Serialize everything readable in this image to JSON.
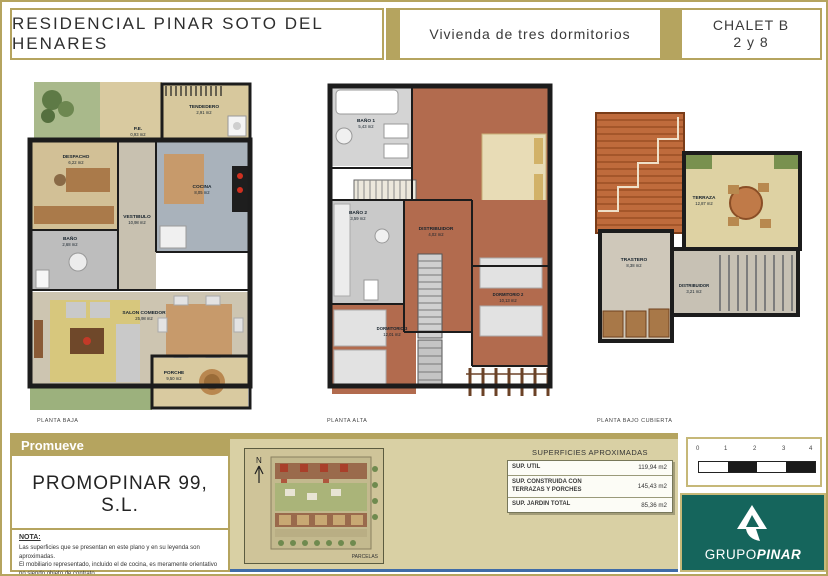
{
  "header": {
    "project_title": "RESIDENCIAL PINAR SOTO DEL HENARES",
    "dwelling_type": "Vivienda de tres dormitorios",
    "chalet_line1": "CHALET B",
    "chalet_line2": "2 y 8"
  },
  "plans": [
    {
      "name": "PLANTA BAJA",
      "rooms": [
        {
          "label": "TENDEDERO",
          "area": "2,91 m2"
        },
        {
          "label": "P.E.",
          "area": "0,93 m2"
        },
        {
          "label": "DESPACHO",
          "area": "6,22 m2"
        },
        {
          "label": "COCINA",
          "area": "8,05 m2"
        },
        {
          "label": "VESTIBULO",
          "area": "10,98 m2"
        },
        {
          "label": "BAÑO",
          "area": "2,68 m2"
        },
        {
          "label": "SALON COMEDOR",
          "area": "25,98 m2"
        },
        {
          "label": "PORCHE",
          "area": "9,50 m2"
        }
      ]
    },
    {
      "name": "PLANTA ALTA",
      "rooms": [
        {
          "label": "BAÑO 1",
          "area": "5,43 m2"
        },
        {
          "label": "DORMITORIO PRINCIPAL",
          "area": "11,75 m2"
        },
        {
          "label": "BAÑO 2",
          "area": "3,59 m2"
        },
        {
          "label": "DISTRIBUIDOR",
          "area": "4,02 m2"
        },
        {
          "label": "DORMITORIO 3",
          "area": "12,01 m2"
        },
        {
          "label": "DORMITORIO 2",
          "area": "10,13 m2"
        }
      ]
    },
    {
      "name": "PLANTA BAJO CUBIERTA",
      "rooms": [
        {
          "label": "TERRAZA",
          "area": "12,87 m2"
        },
        {
          "label": "TRASTERO",
          "area": "8,38 m2"
        },
        {
          "label": "DISTRIBUIDOR",
          "area": "3,21 m2"
        }
      ]
    }
  ],
  "promoter": {
    "band_label": "Promueve",
    "company": "PROMOPINAR 99, S.L."
  },
  "note": {
    "title": "NOTA:",
    "lines": [
      "Las superficies que se presentan en este plano y en su leyenda son aproximadas.",
      "El mobiliario representado, incluido el de cocina, es meramente orientativo no siendo objeto de contrato.",
      "Este plano queda sujeto a posibles modificaciones de carácter técnico."
    ]
  },
  "site_plan": {
    "north_label": "N",
    "caption": "PARCELAS"
  },
  "surfaces": {
    "title": "SUPERFICIES APROXIMADAS",
    "rows": [
      {
        "label": "SUP. UTIL",
        "value": "119,94 m2"
      },
      {
        "label": "SUP. CONSTRUIDA CON TERRAZAS Y PORCHES",
        "value": "145,43 m2"
      },
      {
        "label": "SUP. JARDIN TOTAL",
        "value": "85,36 m2"
      }
    ]
  },
  "scale_bar": {
    "ticks": [
      "0",
      "1",
      "2",
      "3",
      "4"
    ]
  },
  "logo": {
    "brand_regular": "GRUPO",
    "brand_bold": "PINAR"
  },
  "colors": {
    "gold": "#b5a45f",
    "teal_logo_bg": "#15655c",
    "cream_panel": "#d9d0a4",
    "blue_rule": "#3f6ca8",
    "wood_floor": "#b26b4e",
    "roof_tile": "#bf6b3c"
  }
}
